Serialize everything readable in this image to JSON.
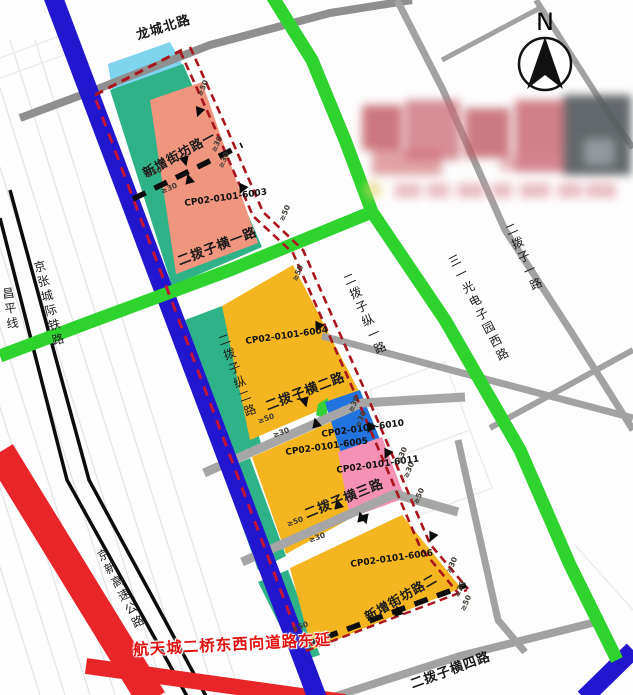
{
  "compass": {
    "north": "N"
  },
  "roads": {
    "longcheng_north": "龙城北路",
    "erbozi_1": "二拨子一路",
    "sanyi_optoelec_west": "三一光电子园西路",
    "jingzhang_railway": "京张城际铁路",
    "changping_line": "昌平线",
    "jingxin_expressway": "京新高速公路",
    "erbozi_heng_1": "二拨子横一路",
    "erbozi_heng_2": "二拨子横二路",
    "erbozi_heng_3": "二拨子横三路",
    "erbozi_heng_4": "二拨子横四路",
    "erbozi_zong_1": "二拨子纵一路",
    "erbozi_zong_2": "二拨子纵二路",
    "new_block_road_1": "新增街坊路一",
    "new_block_road_2": "新增街坊路二",
    "hangtiancheng_ext": "航天城二桥东西向道路东延"
  },
  "parcels": {
    "p6003": {
      "code": "CP02-0101-6003",
      "color": "#f0957e"
    },
    "p6004": {
      "code": "CP02-0101-6004",
      "color": "#f4b521"
    },
    "p6005": {
      "code": "CP02-0101-6005",
      "color": "#f4b521"
    },
    "p6006": {
      "code": "CP02-0101-6006",
      "color": "#f4b521"
    },
    "p6010": {
      "code": "CP02-0101-6010",
      "color": "#2173dd"
    },
    "p6011": {
      "code": "CP02-0101-6011",
      "color": "#f491b5"
    }
  },
  "dimensions": {
    "min50": "≥50",
    "min30": "≥30"
  },
  "colors": {
    "road_blue": "#2216cf",
    "road_green": "#2ed32e",
    "road_red": "#e8262a",
    "road_gray": "#a2a2a2",
    "rail_black": "#0c0c0c",
    "boundary_red": "#a8151d",
    "boundary_magenta": "#c11437",
    "parcel_teal": "#2fb287",
    "parcel_cyan": "#7fd4ee",
    "new_road_black": "#0d0d0d"
  }
}
